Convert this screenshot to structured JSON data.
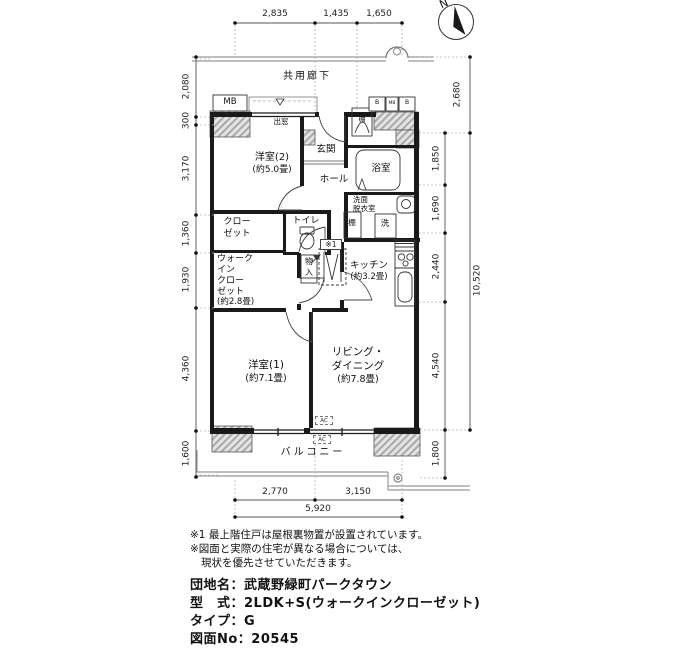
{
  "compass": {
    "north_label": "N"
  },
  "dims": {
    "top": [
      "2,835",
      "1,435",
      "1,650"
    ],
    "left": [
      "2,080",
      "300",
      "3,170",
      "1,360",
      "1,930",
      "4,360",
      "1,600"
    ],
    "right_inner": [
      "1,850",
      "1,690",
      "2,440",
      "4,540",
      "1,800"
    ],
    "right_outer": [
      "2,680",
      "10,520"
    ],
    "bottom": [
      "2,770",
      "3,150"
    ],
    "bottom_total": "5,920"
  },
  "labels": {
    "corridor": "共用廊下",
    "mb": "MB",
    "meter_b1": "B",
    "meter_mb": "MB",
    "meter_b2": "B",
    "bay_window": "出窓",
    "bedroom2_name": "洋室(2)",
    "bedroom2_size": "(約5.0畳)",
    "entrance": "玄関",
    "hall": "ホール",
    "bath": "浴室",
    "washroom_l1": "洗面",
    "washroom_l2": "脱衣室",
    "shelf_top": "棚",
    "shelf_mid": "棚",
    "washer": "洗",
    "closet_l1": "クロー",
    "closet_l2": "ゼット",
    "toilet": "トイレ",
    "storage_l1": "物",
    "storage_l2": "入",
    "note_ref": "※1",
    "wic_l1": "ウォーク",
    "wic_l2": "イン",
    "wic_l3": "クロー",
    "wic_l4": "ゼット",
    "wic_size": "(約2.8畳)",
    "kitchen_name": "キッチン",
    "kitchen_size": "(約3.2畳)",
    "bedroom1_name": "洋室(1)",
    "bedroom1_size": "(約7.1畳)",
    "living_l1": "リビング・",
    "living_l2": "ダイニング",
    "living_size": "(約7.8畳)",
    "balcony": "バルコニー",
    "ac": "AC"
  },
  "notes": [
    "※1 最上階住戸は屋根裏物置が設置されています。",
    "※図面と実際の住宅が異なる場合については、",
    "現状を優先させていただきます。"
  ],
  "info": [
    "団地名：武蔵野緑町パークタウン",
    "型　式：2LDK+S(ウォークインクローゼット)",
    "タイプ：G",
    "図面No：20545"
  ]
}
